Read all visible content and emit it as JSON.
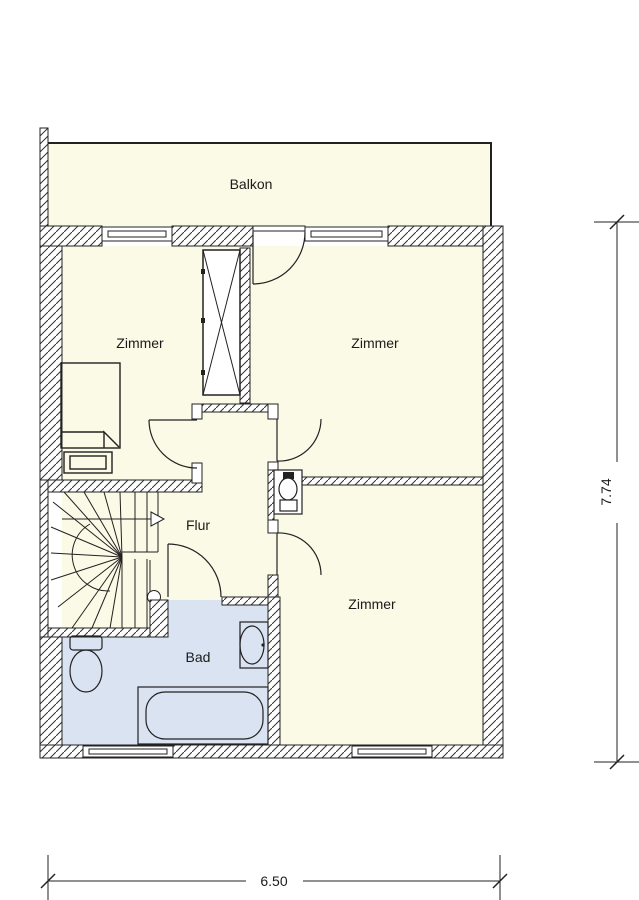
{
  "plan": {
    "title": "Obergeschoss Grundriss",
    "labels": {
      "balcony": "Balkon",
      "room_upper_left": "Zimmer",
      "room_upper_right": "Zimmer",
      "hallway": "Flur",
      "bathroom": "Bad",
      "room_lower_right": "Zimmer"
    },
    "dimensions": {
      "width_label": "6.50",
      "height_label": "7.74"
    },
    "colors": {
      "floor": "#FBFAE6",
      "bathroom_floor": "#D9E3F2",
      "line": "#1b1b1b",
      "background": "#FFFFFF"
    },
    "icons": {
      "stairs_arrow_icon": "triangle-right",
      "chimney_icon": "rect-with-x-cross",
      "toilet_icon": "oval-bowl-with-tank",
      "wc_icon": "oval-bowl-with-tank",
      "sink_icon": "oval-basin",
      "bathtub_icon": "rounded-tub",
      "bed_icon": "rect-with-folded-blanket",
      "window_icon": "double-line-rect",
      "door_icon": "quarter-arc-swing"
    }
  }
}
